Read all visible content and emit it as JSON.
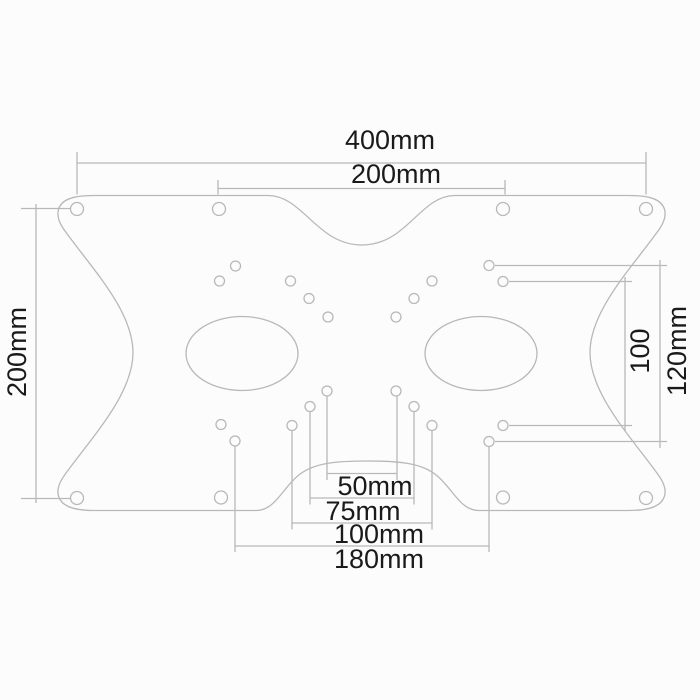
{
  "diagram": {
    "colors": {
      "line": "#b8b8b8",
      "text": "#1a1a1a",
      "background": "#fdfcfc"
    },
    "labels": {
      "top_width": "400mm",
      "top_inner_width": "200mm",
      "left_height": "200mm",
      "right_inner_height": "100",
      "right_outer_height": "120mm",
      "bottom_width_50": "50mm",
      "bottom_width_75": "75mm",
      "bottom_width_100": "100mm",
      "bottom_width_180": "180mm"
    }
  }
}
